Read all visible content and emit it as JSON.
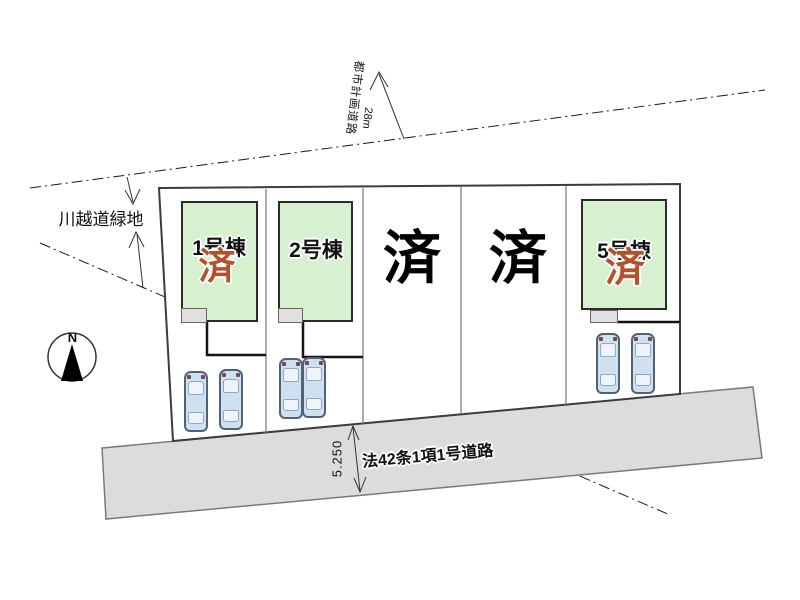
{
  "compass": {
    "north": "N"
  },
  "boundary": {
    "green_space_label": "川越道緑地",
    "planning_road_label": "都市計画道路",
    "planning_road_width": "28m"
  },
  "road": {
    "name": "法42条1項1号道路",
    "width_dimension": "5.250"
  },
  "lots": [
    {
      "name": "1号棟",
      "status": "済"
    },
    {
      "name": "2号棟",
      "status": ""
    },
    {
      "name": "",
      "status": "済"
    },
    {
      "name": "",
      "status": "済"
    },
    {
      "name": "5号棟",
      "status": "済"
    }
  ],
  "colors": {
    "building_green": "#d7f0d0",
    "road_gray": "#dcdcdc",
    "sold_red": "#b0522e",
    "car_blue": "#cfe0f0"
  }
}
